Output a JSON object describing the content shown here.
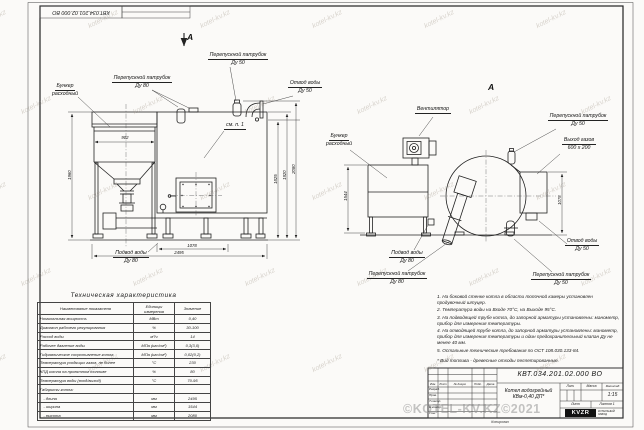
{
  "page": {
    "corner_stamp": "КВТ.034.201.02.000  ВО",
    "watermark_tile": "kotel-kv.kz",
    "watermark_big": "©KOTEL-KV.KZ©2021"
  },
  "front": {
    "section_letter": "А",
    "callouts": {
      "bunker": "Бункер\nрасходный",
      "bypass80": "Перепускной патрубок\nДу 80",
      "bypass50": "Перепускной патрубок\nДу 50",
      "water_out": "Отвод воды\nДу 50",
      "water_in": "Подвод воды\nДу 80",
      "see_note": "см. п. 1"
    },
    "dims": {
      "left": "1960",
      "hopper": "902",
      "r1": "1825",
      "r2": "1920",
      "r3": "2080",
      "b1": "1078",
      "b2": "2495"
    }
  },
  "side": {
    "view_letter": "А",
    "callouts": {
      "fan": "Вентилятор",
      "bunker": "Бункер\nрасходный",
      "bypass50_top": "Перепускной патрубок\nДу 50",
      "gas_out": "Выход газов\n600 х 200",
      "water_in": "Подвод воды\nДу 80",
      "bypass80": "Перепускной патрубок\nДу 80",
      "bypass50_bottom": "Перепускной патрубок\nДу 50",
      "water_out": "Отвод воды\nДу 50"
    },
    "dims": {
      "depth": "1544",
      "right": "1078"
    }
  },
  "tech_table": {
    "title": "Техническая характеристика",
    "headers": [
      "Наименование показателя",
      "Единицы измерения",
      "Значение"
    ],
    "rows": [
      [
        "Номинальная мощность",
        "МВт",
        "0,40"
      ],
      [
        "Диапазон рабочего регулирования",
        "%",
        "30-100"
      ],
      [
        "Расход воды",
        "м³/ч",
        "14"
      ],
      [
        "Рабочее давление воды",
        "МПа (кгс/см²)",
        "0,3(3,0)"
      ],
      [
        "Гидравлическое сопротивление котла",
        "МПа (кгс/см²)",
        "0,02(0,2)"
      ],
      [
        "Температура уходящих газов, не более",
        "°С",
        "230"
      ],
      [
        "КПД котла на проектном топливе",
        "%",
        "80"
      ],
      [
        "Температура воды (вход/выход)",
        "°С",
        "70-95"
      ],
      [
        "Габариты котла:",
        "",
        ""
      ],
      [
        "   - длина",
        "мм",
        "2495"
      ],
      [
        "   - ширина",
        "мм",
        "1544"
      ],
      [
        "   - высота",
        "мм",
        "2080"
      ]
    ]
  },
  "notes": {
    "items": [
      "1.  На боковой стенке котла в области топочной камеры установлен продувочный штуцер.",
      "2.  Температура воды на Входе 70°С, на Выходе 95°С.",
      "3.  На подводящей трубе котла, до запорной арматуры установлены: манометр, прибор для измерения температуры.",
      "4.  На отводящей трубе котла, до запорной арматуры установлены: манометр, прибор для измерения температуры и один предохранительный клапан Ду не менее 40 мм.",
      "5.  Остальные технические требования по ОСТ 108.030.133-84.",
      "*  Вид топлива - древесные отходы пеллетированные."
    ]
  },
  "tb": {
    "doc_number": "КВТ.034.201.02.000  ВО",
    "product": "Котел водогрейный\nКВм-0,40  ДП*",
    "hdr_izm": "Изм.",
    "hdr_list": "Лист",
    "hdr_doc": "№ докум.",
    "hdr_sign": "Подп.",
    "hdr_date": "Дата",
    "rows": [
      "Разраб.",
      "Пров.",
      "Т.контр.",
      "Н.контр.",
      "Утв."
    ],
    "lit": "Лит.",
    "mass": "Масса",
    "scale_hdr": "Масштаб",
    "scale": "1:15",
    "sheet": "Лист",
    "sheets": "Листов 1",
    "logo": "KVZR",
    "logo_side": "КОТЕЛЬНЫЙ\nЗАВОД",
    "copied": "Копировал"
  }
}
